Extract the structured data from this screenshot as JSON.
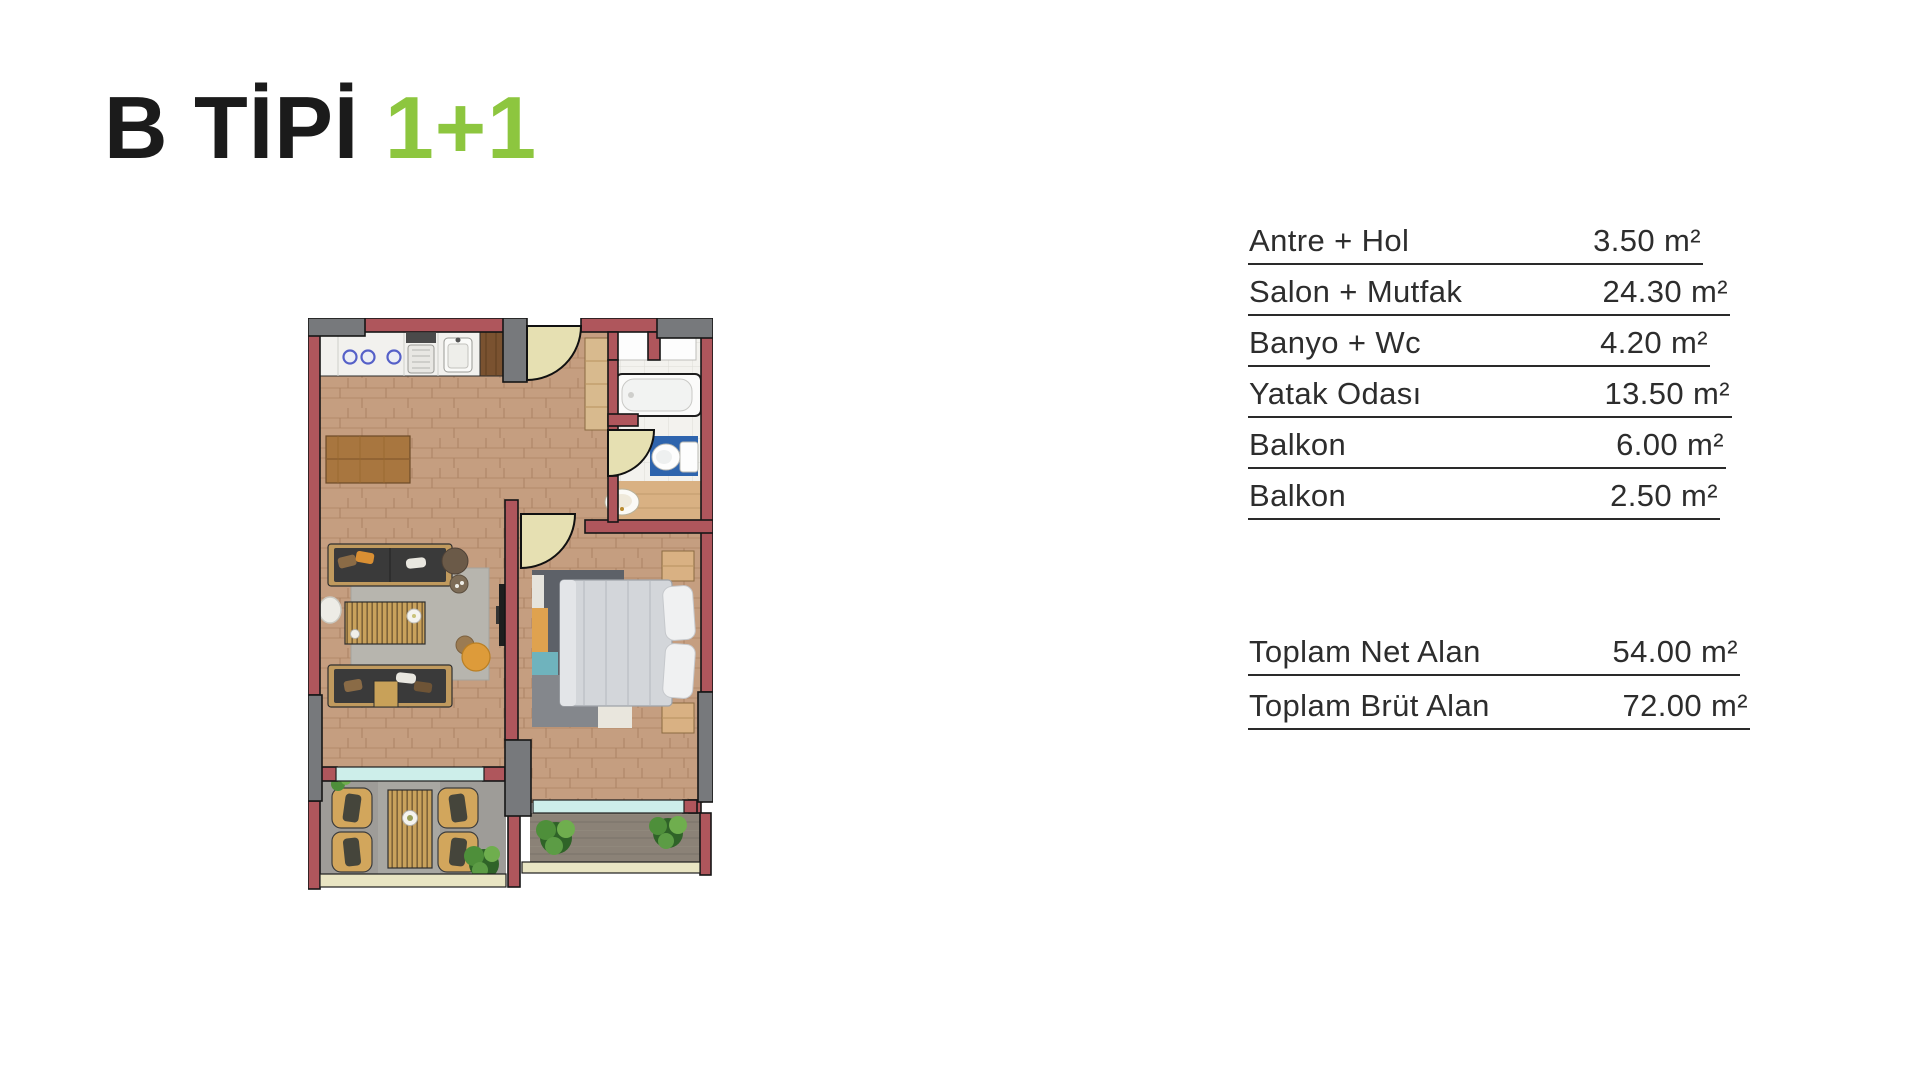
{
  "title": {
    "type": "B TİPİ",
    "rooms": "1+1",
    "type_color": "#1b1b1b",
    "rooms_color": "#8dc63f"
  },
  "areas": {
    "rows": [
      {
        "label": "Antre + Hol",
        "value": "3.50 m²"
      },
      {
        "label": "Salon + Mutfak",
        "value": "24.30 m²"
      },
      {
        "label": "Banyo + Wc",
        "value": "4.20 m²"
      },
      {
        "label": "Yatak Odası",
        "value": "13.50 m²"
      },
      {
        "label": "Balkon",
        "value": "6.00 m²"
      },
      {
        "label": "Balkon",
        "value": "2.50 m²"
      }
    ],
    "totals": [
      {
        "label": "Toplam Net Alan",
        "value": "54.00 m²"
      },
      {
        "label": "Toplam Brüt Alan",
        "value": "72.00 m²"
      }
    ]
  },
  "floor_plan": {
    "description": "Top-down rendered floor plan of B type 1+1 apartment",
    "rooms": [
      "Antre + Hol",
      "Salon + Mutfak",
      "Banyo + Wc",
      "Yatak Odası",
      "Balkon",
      "Balkon"
    ],
    "colors": {
      "wall_red": "#af565c",
      "column_gray": "#77797c",
      "wood_floor": "#c59e80",
      "bath_tile": "#f3f2ee",
      "glass_teal": "#cdeeea",
      "railing_beige": "#e9e5c3",
      "door_leaf": "#e6e0b2",
      "toilet_mat_blue": "#2e64ad",
      "rug_gray": "#b7b5ae",
      "bedroom_rug": "#5d6168",
      "accent_orange": "#dd9b3a"
    }
  }
}
